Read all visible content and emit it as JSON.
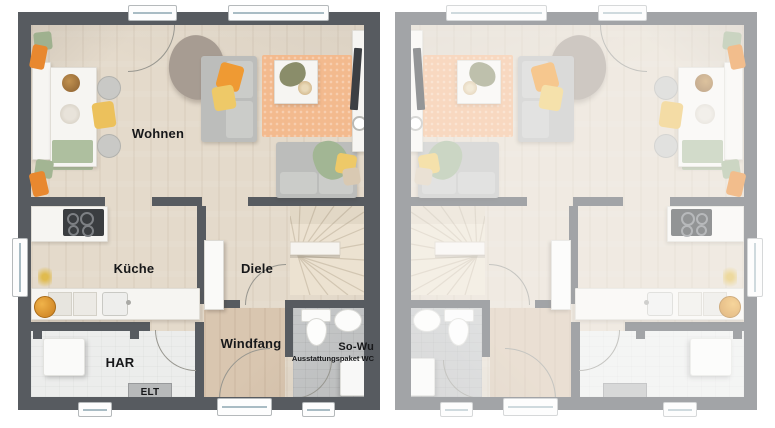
{
  "plan": {
    "type": "floorplan",
    "units": {
      "left": {
        "state": "active",
        "labels_visible": true
      },
      "right": {
        "state": "mirrored-faded",
        "labels_visible": false
      }
    }
  },
  "rooms": {
    "wohnen": {
      "label": "Wohnen"
    },
    "kueche": {
      "label": "Küche"
    },
    "diele": {
      "label": "Diele"
    },
    "windfang": {
      "label": "Windfang"
    },
    "har": {
      "label": "HAR"
    },
    "so_wu": {
      "label": "So-Wu",
      "sublabel": "Ausstattungspaket WC"
    },
    "elt": {
      "label": "ELT"
    }
  },
  "colors": {
    "wall_active": "#575b60",
    "wall_faded": "#9da0a4",
    "floor_wood": "#e4dacb",
    "floor_vestibule": "#d9c6b0",
    "floor_tile_white": "#ecedec",
    "floor_tile_gray": "#c5c7c8",
    "rug_orange": "#f3ba8e",
    "accent_orange": "#ef9a33",
    "accent_yellow": "#eec968",
    "accent_green": "#a2b694",
    "sofa_gray": "#bcbdbb",
    "background": "#ffffff"
  }
}
